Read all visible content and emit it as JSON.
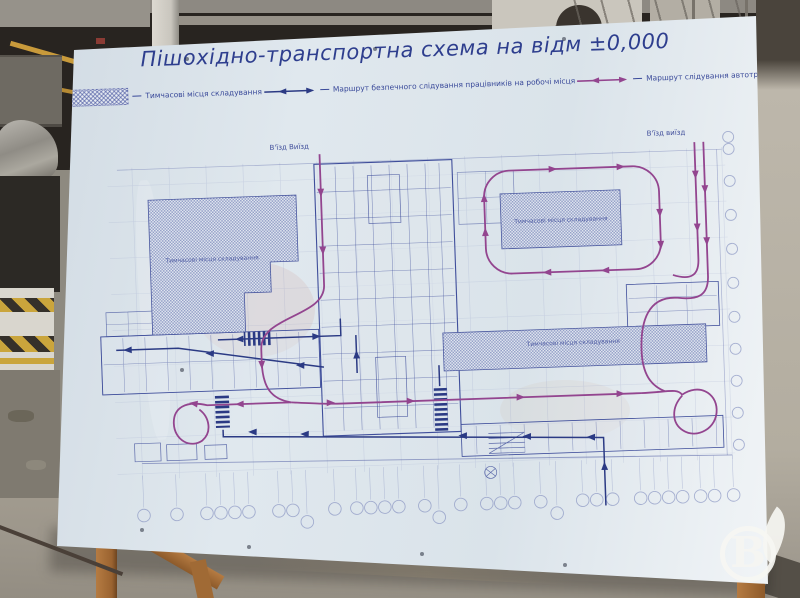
{
  "board": {
    "title": "Пішохідно-транспортна схема на відм ±0,000",
    "legend": {
      "items": [
        {
          "icon": "storage-hatch-swatch",
          "label": "Тимчасові місця складування"
        },
        {
          "icon": "worker-route-arrow",
          "label": "Маршрут безпечного слідування працівників на робочі місця"
        },
        {
          "icon": "vehicle-route-arrow",
          "label": "Маршрут слідування автотранспорту"
        },
        {
          "icon": "pedestrian-crossing-swatch",
          "label": "Пішохідний перехід"
        }
      ]
    },
    "plan": {
      "entry_top_center": "В'їзд Виїзд",
      "entry_top_right": "В'їзд виїзд",
      "storage_area_labels": [
        "Тимчасові місця складування",
        "Тимчасові місця складування",
        "Тимчасові місця складування"
      ]
    },
    "colors": {
      "title_ink": "#2e3e8e",
      "blueprint_ink": "#4a58a0",
      "worker_route": "#2b3a84",
      "vehicle_route": "#93458f",
      "board_surface": "#dce4eb"
    }
  },
  "watermark": {
    "letter": "B"
  }
}
